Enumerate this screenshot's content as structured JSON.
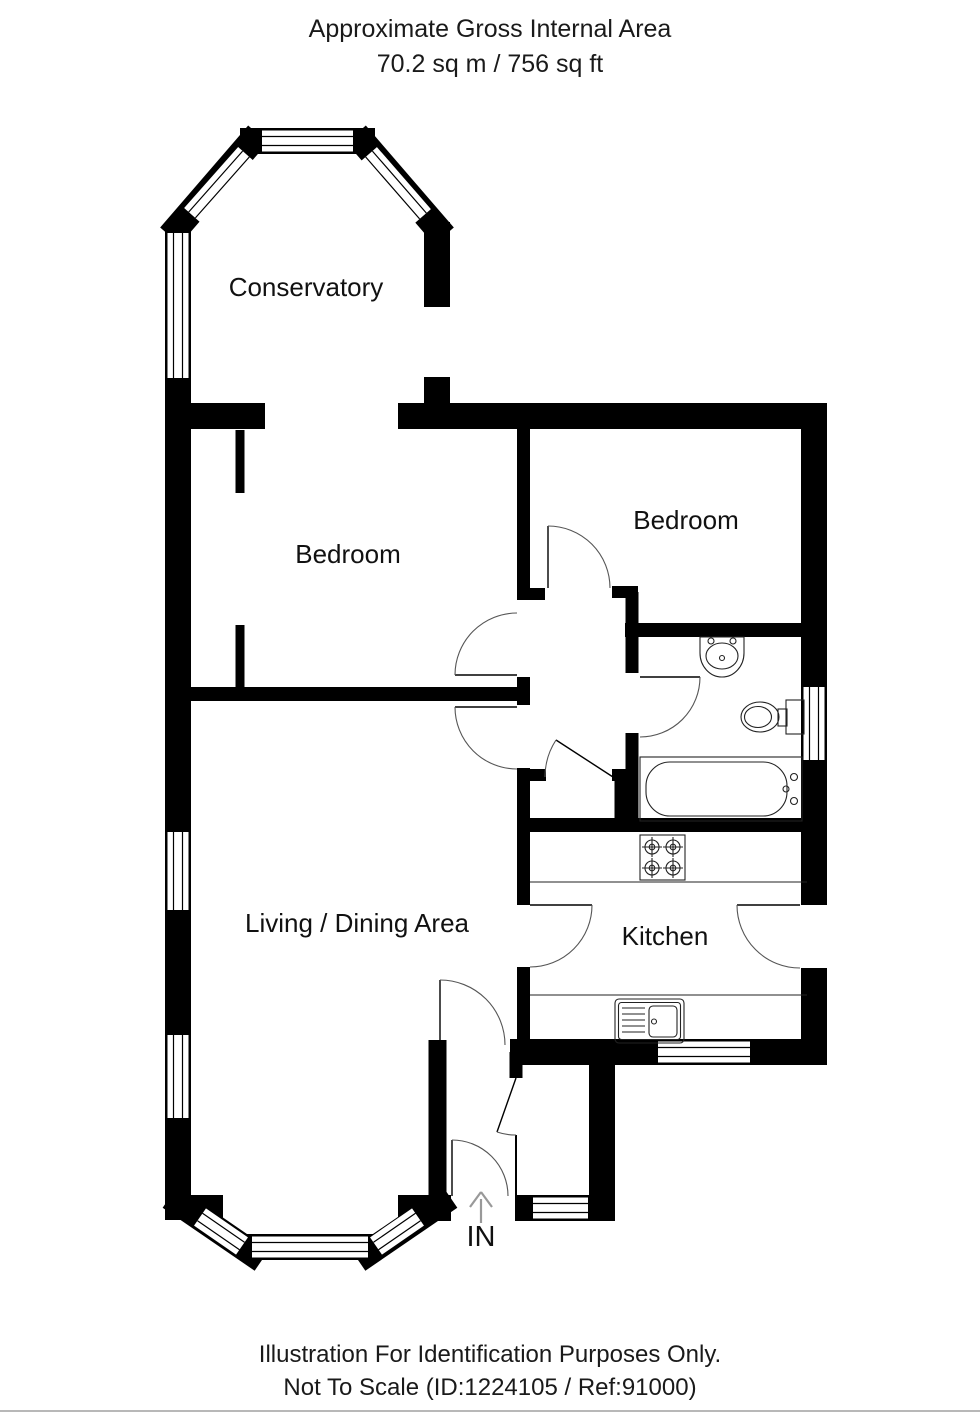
{
  "header": {
    "line1": "Approximate Gross Internal Area",
    "line2": "70.2 sq m / 756 sq ft"
  },
  "rooms": {
    "conservatory": "Conservatory",
    "bedroom_left": "Bedroom",
    "bedroom_right": "Bedroom",
    "living_dining": "Living / Dining Area",
    "kitchen": "Kitchen"
  },
  "entrance": {
    "label": "IN"
  },
  "footer": {
    "line1": "Illustration For Identification Purposes Only.",
    "line2": "Not To Scale (ID:1224105 / Ref:91000)"
  },
  "colors": {
    "wall": "#000000",
    "background": "#ffffff",
    "text": "#1a1a1a",
    "door_arc": "#555555",
    "arrow": "#999999"
  }
}
